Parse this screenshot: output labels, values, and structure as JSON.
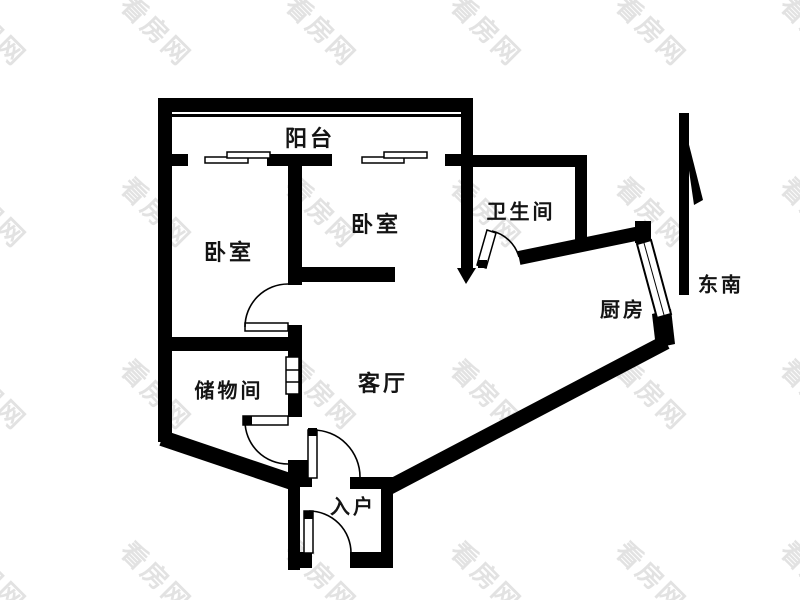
{
  "title": "apartment-floor-plan",
  "watermark": {
    "text": "看房网",
    "color": "#e2e2e2"
  },
  "colors": {
    "wall": "#000000",
    "label": "#141414",
    "background": "#ffffff"
  },
  "compass": {
    "direction_label": "东南"
  },
  "rooms": {
    "balcony": {
      "label": "阳台"
    },
    "bedroom_left": {
      "label": "卧室"
    },
    "bedroom_right": {
      "label": "卧室"
    },
    "bathroom": {
      "label": "卫生间"
    },
    "kitchen": {
      "label": "厨房"
    },
    "storage": {
      "label": "储物间"
    },
    "living_room": {
      "label": "客厅"
    },
    "entry": {
      "label": "入户"
    }
  }
}
